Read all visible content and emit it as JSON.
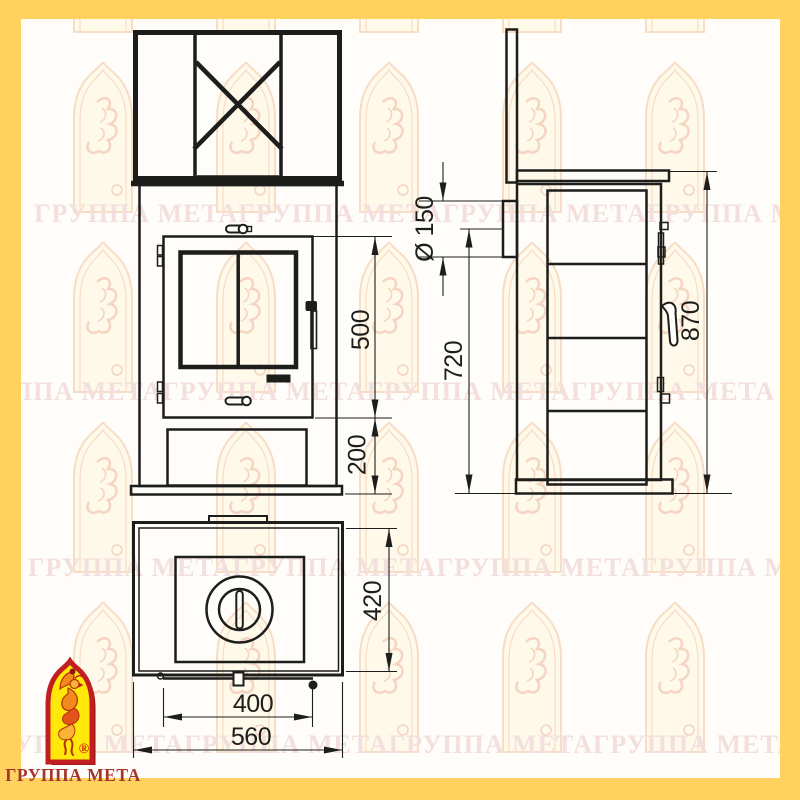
{
  "colors": {
    "frame_yellow": "#FFD25F",
    "paper": "#FFFDFA",
    "ink": "#1D1D1B",
    "watermark_text": "#F3DFDD",
    "watermark_arch": "#F6D3B9",
    "logo_border_red": "#C01E20",
    "logo_fill_yellow": "#FFE70A",
    "logo_bird_orange": "#F28A1E",
    "caption_red": "#A5352B"
  },
  "watermark": {
    "row_text": "ГРУППА МЕТАГРУППА МЕТАГРУППА МЕТАГРУППА МЕТА"
  },
  "dimensions": {
    "door_height": "500",
    "base_height": "200",
    "flue_diameter": "Ø 150",
    "flue_axis_height": "720",
    "overall_height": "870",
    "overall_depth": "420",
    "door_width": "400",
    "overall_width": "560"
  },
  "logo": {
    "caption": "ГРУППА МЕТА",
    "registered_mark": "®"
  }
}
